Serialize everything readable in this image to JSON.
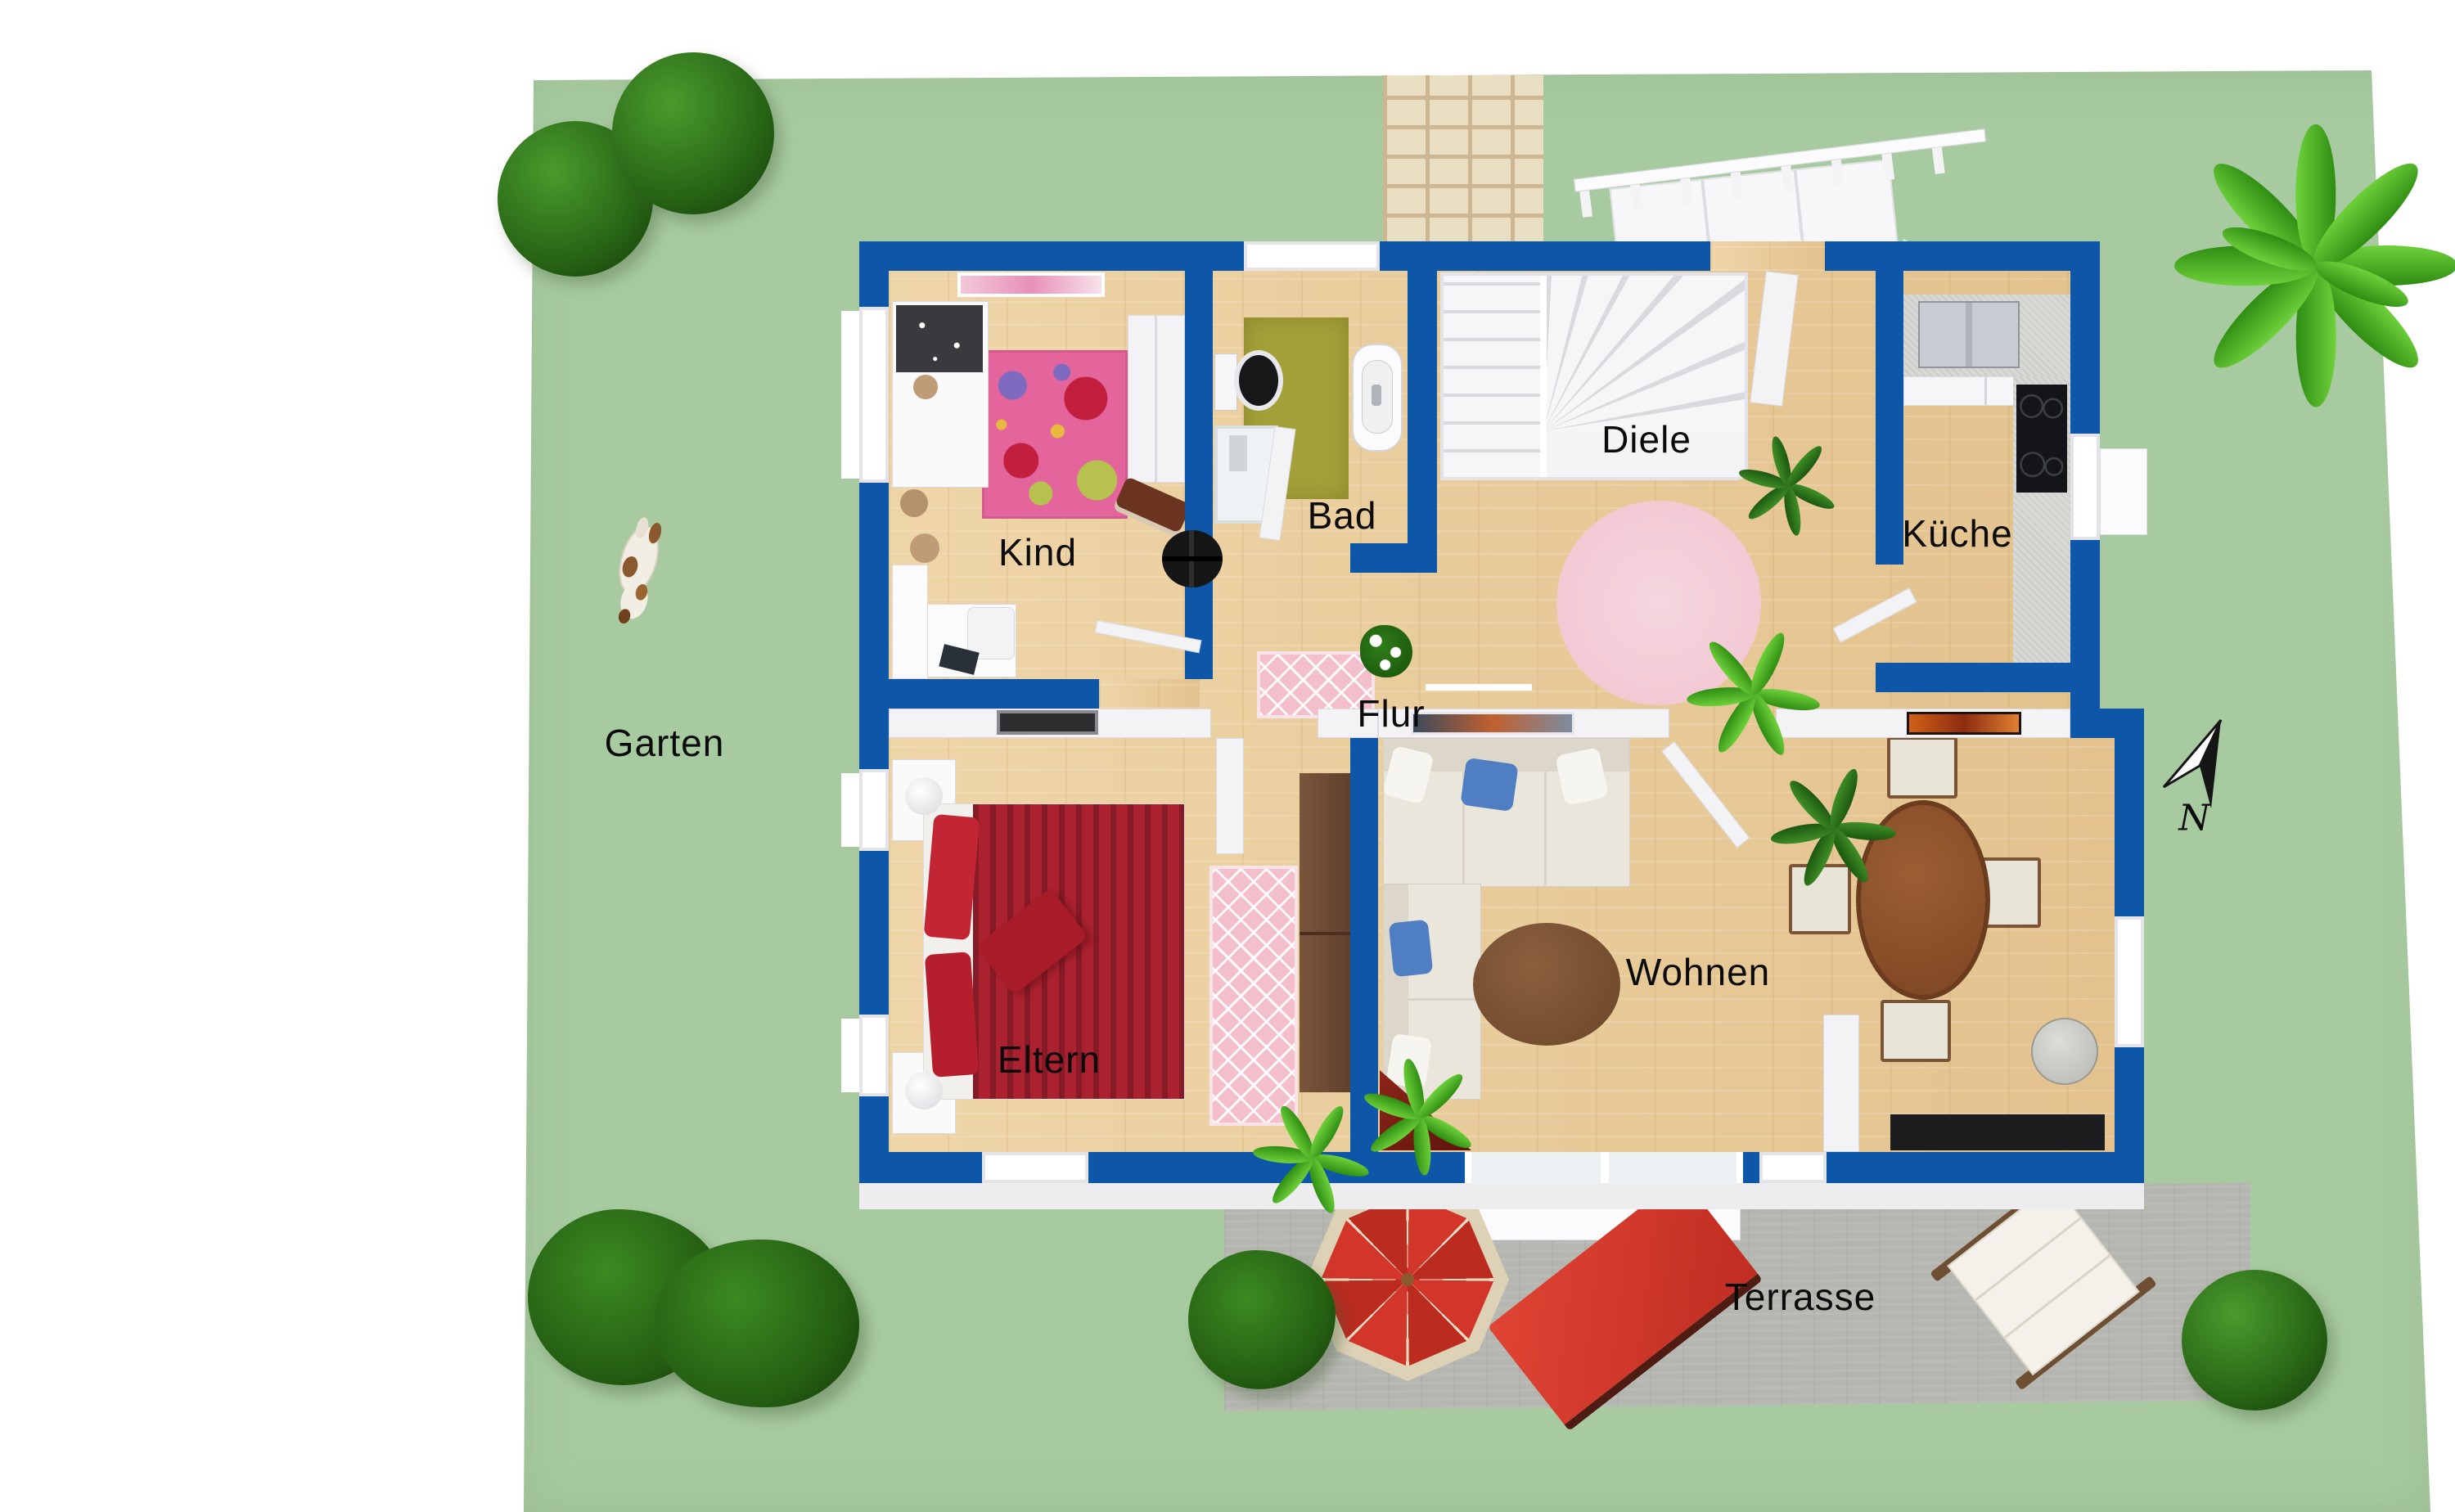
{
  "labels": {
    "garden": "Garten",
    "child_room": "Kind",
    "bathroom": "Bad",
    "foyer": "Diele",
    "kitchen": "Küche",
    "hall": "Flur",
    "master_bedroom": "Eltern",
    "living_room": "Wohnen",
    "terrace": "Terrasse",
    "compass_north": "N"
  },
  "colors": {
    "exterior_wall": "#0e56a7",
    "interior_wall": "#f3f3f6",
    "garden_green": "#a8caa0",
    "wood_floor": "#e9cfa2",
    "terrace_stone": "#b5b6b0",
    "accent_red": "#d23529",
    "bed_red": "#ab2130",
    "kids_rug_pink": "#e4649c",
    "bath_rug_olive": "#a5a13a",
    "foyer_rug_rose": "#f3ccd7"
  },
  "depicted_objects": [
    "topiary-tree",
    "palm-shrub",
    "garden-dog",
    "compass-north-arrow",
    "entry-walkway",
    "entry-ramp-railing",
    "winder-staircase",
    "kids-bed",
    "flower-rug",
    "teddy-bears",
    "kids-desk",
    "toy-sled",
    "wardrobe",
    "toilet",
    "washbasin",
    "shower",
    "bath-rug",
    "kitchen-sink",
    "cooktop",
    "kitchen-counter",
    "double-bed",
    "nightstand-lamps",
    "runner-rug",
    "bedroom-wardrobe",
    "corner-sofa",
    "coffee-table",
    "dining-table",
    "dining-chairs",
    "tv-board",
    "corner-fireplace",
    "houseplants",
    "round-rug",
    "parasol",
    "sun-lounger-red",
    "sun-lounger-white",
    "garden-bushes"
  ]
}
